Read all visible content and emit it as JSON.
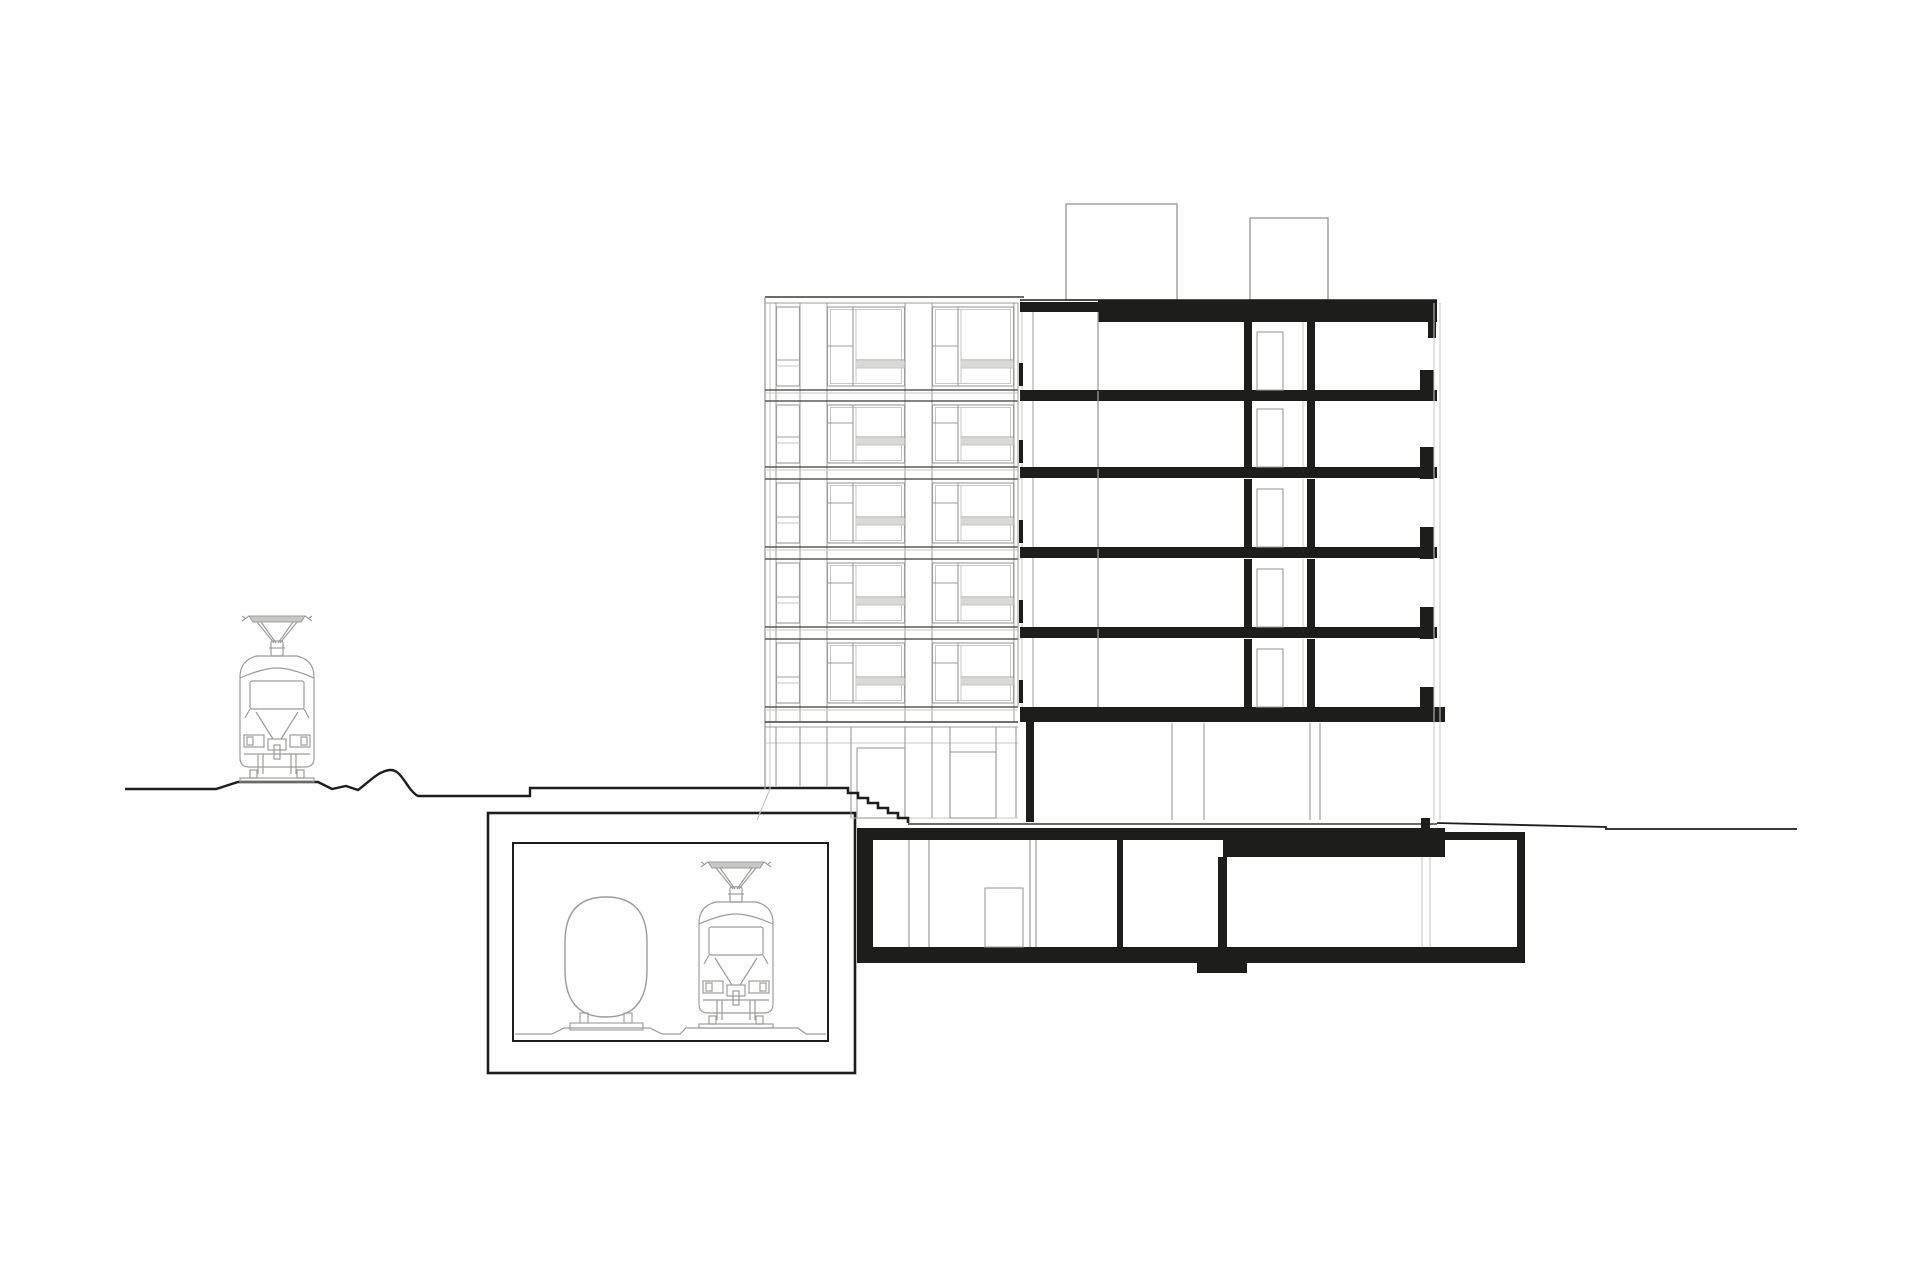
{
  "meta": {
    "description": "Black-and-white architectural cross-section drawing: six-storey building (left half elevation, right half section cut in solid black poché) over a basement, with two rooftop structures, an entrance stair, a tram at street level on the left, and an underground tunnel box containing a tunnel profile and a train",
    "storeys_above_ground": 6,
    "basement_levels": 1,
    "rooftop_structures": 2,
    "vehicles": 2
  },
  "colors": {
    "paper": "#ffffff",
    "ink": "#1d1d1b",
    "dark": "#3a3a39",
    "gray": "#9c9c9b",
    "light": "#c7c7c6",
    "panel": "#d8d8d7"
  },
  "ground": {
    "left_d": "M125 789 H216 L238 782 H318 L332 789 L346 786 L358 790 C368 783 379 770 391 770 C402 770 407 790 418 796 H530 V788 H838",
    "right_d": "M1437 823 L1606 827 V829 H1797",
    "plaza": {
      "y": 824,
      "x1": 908,
      "x2": 1437
    },
    "stairs": {
      "x": 838,
      "y": 788,
      "steps": 7,
      "step_w": 10,
      "step_h": 5
    }
  },
  "vehicles": {
    "tram": {
      "x": 235,
      "y": 615
    },
    "train": {
      "x": 694,
      "y": 861
    }
  },
  "tunnel": {
    "outer": [
      488,
      813,
      367,
      260
    ],
    "inner": [
      513,
      843,
      315,
      198
    ],
    "ground_d": "M515 1034 H552 L564 1028 H650 L662 1034 H680 L686 1028 H798 L806 1034 H826",
    "profile_d": "M565 942 Q565 897 606 897 Q647 897 647 942 V970 Q647 1017 606 1017 Q565 1017 565 970 Z",
    "feet": [
      [
        580,
        1013,
        8,
        10
      ],
      [
        624,
        1013,
        8,
        10
      ]
    ],
    "plate": [
      570,
      1023,
      73,
      7
    ]
  },
  "elevation": {
    "x1": 765,
    "x2": 1018,
    "parapet": [
      297,
      303
    ],
    "left_edge": [
      765,
      770
    ],
    "slope_d": "M770 789 L757 820",
    "pier_lines": [
      776,
      800,
      827,
      905,
      932,
      1014
    ],
    "pier_top": 303,
    "pier_bot": 722,
    "bands": [
      [
        390,
        401
      ],
      [
        467,
        479
      ],
      [
        547,
        559
      ],
      [
        627,
        639
      ],
      [
        707,
        722
      ]
    ],
    "rows": [
      [
        303,
        390
      ],
      [
        401,
        467
      ],
      [
        479,
        547
      ],
      [
        559,
        627
      ],
      [
        639,
        707
      ]
    ],
    "wide_bays": [
      [
        827,
        905
      ],
      [
        932,
        1014
      ]
    ],
    "narrow_bays": [
      [
        776,
        800
      ]
    ],
    "storefront": {
      "top": 722,
      "line2": 727,
      "transom": 743,
      "bot": 818,
      "mullions": [
        776,
        800,
        827,
        851,
        905,
        932,
        950,
        996,
        1016
      ],
      "short_until": 845,
      "short_bot": 786,
      "doors": [
        [
          857,
          748,
          48,
          70
        ],
        [
          950,
          752,
          46,
          66
        ]
      ]
    },
    "balcony": {
      "lines": [
        1018,
        1022,
        1033
      ],
      "top": 303,
      "bot": 707,
      "ticks_x": 1019,
      "tick_w": 4,
      "tick_h": 23
    }
  },
  "roof_boxes": [
    [
      1066,
      204,
      111,
      96
    ],
    [
      1250,
      218,
      78,
      82
    ]
  ],
  "section": {
    "x1": 1020,
    "x2": 1437,
    "roof_line_y": 300,
    "roof_thin": [
      1020,
      302,
      78,
      10
    ],
    "roof_thick": [
      1098,
      300,
      339,
      22
    ],
    "roof_cap": [
      1428,
      322,
      8,
      16
    ],
    "slab_tops": [
      390,
      467,
      547,
      627
    ],
    "slab_h": 11,
    "gf_slab": [
      1020,
      707,
      425,
      15
    ],
    "rows": [
      [
        322,
        390
      ],
      [
        401,
        467
      ],
      [
        479,
        547
      ],
      [
        559,
        627
      ],
      [
        639,
        707
      ]
    ],
    "wall_a": [
      1244,
      8
    ],
    "wall_b": [
      1307,
      8
    ],
    "door": [
      1257,
      26,
      58
    ],
    "wall_line_x": 1098,
    "thin_line_x": 1303,
    "right_blocks": {
      "x": 1420,
      "w": 14,
      "tops": [
        370,
        447,
        527,
        607,
        687
      ],
      "bots": [
        401,
        479,
        559,
        639,
        722
      ]
    },
    "gf": {
      "top": 722,
      "bot": 822,
      "left_wall": [
        1026,
        722,
        8,
        100
      ],
      "mullions": [
        1172,
        1204,
        1310,
        1320
      ],
      "base_col": [
        1421,
        818,
        9,
        14
      ]
    },
    "facade_lines": [
      1434,
      1440
    ]
  },
  "basement": {
    "top_slab_a": [
      857,
      828,
      366,
      12
    ],
    "top_slab_b": [
      1223,
      828,
      222,
      29
    ],
    "top_slab_c": [
      1445,
      832,
      72,
      8
    ],
    "left_wall": [
      857,
      828,
      16,
      134
    ],
    "floor_slab": [
      857,
      947,
      668,
      16
    ],
    "step_block": [
      1197,
      963,
      50,
      10
    ],
    "right_wall": [
      1517,
      832,
      8,
      131
    ],
    "walls": [
      [
        1117,
        840,
        6,
        107
      ],
      [
        1218,
        857,
        9,
        90
      ]
    ],
    "thin_walls_x": [
      909,
      929,
      1030,
      1036
    ],
    "thin_top": 840,
    "thin_bot": 947,
    "facade_cont_x": [
      1422,
      1430
    ],
    "facade_top": 857,
    "door": [
      985,
      888,
      38,
      59
    ]
  }
}
